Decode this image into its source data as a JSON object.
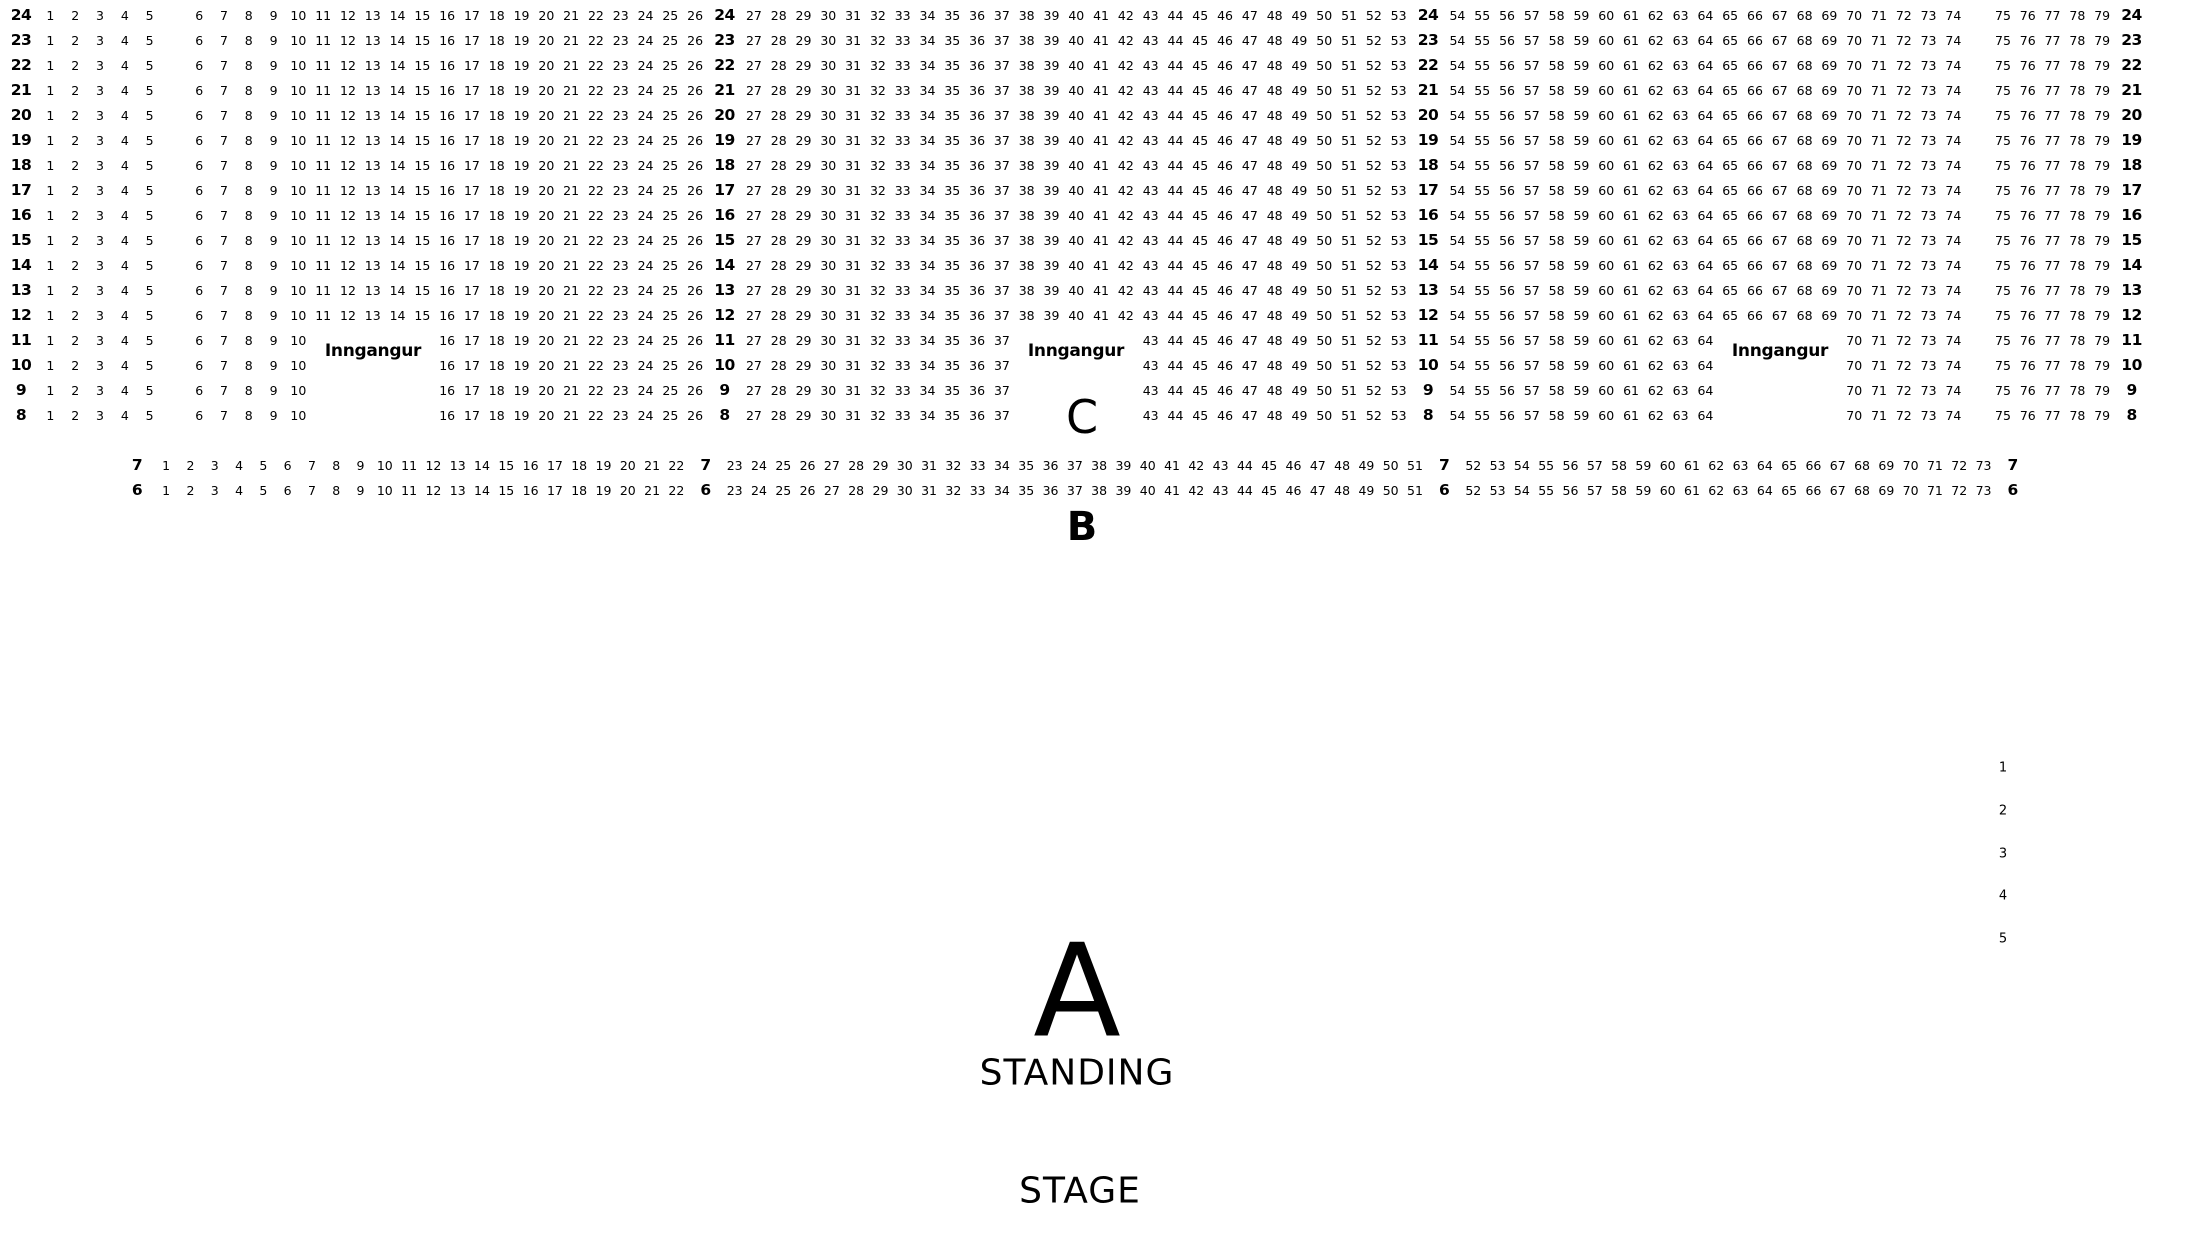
{
  "colors": {
    "background": "#ffffff",
    "text": "#000000"
  },
  "seatmap": {
    "entrance_label": "Inngangur",
    "section_c_label": "C",
    "section_b_label": "B",
    "section_a_label": "A",
    "standing_label": "STANDING",
    "stage_label": "STAGE",
    "side_row_numbers": [
      "1",
      "2",
      "3",
      "4",
      "5"
    ],
    "row_templates": {
      "full": [
        {
          "t": "label"
        },
        {
          "t": "seats",
          "from": 1,
          "to": 5
        },
        {
          "t": "gap",
          "n": 1
        },
        {
          "t": "seats",
          "from": 6,
          "to": 26
        },
        {
          "t": "label"
        },
        {
          "t": "seats",
          "from": 27,
          "to": 53
        },
        {
          "t": "label"
        },
        {
          "t": "seats",
          "from": 54,
          "to": 74
        },
        {
          "t": "gap",
          "n": 1
        },
        {
          "t": "seats",
          "from": 75,
          "to": 79
        },
        {
          "t": "label"
        }
      ],
      "split": [
        {
          "t": "label"
        },
        {
          "t": "seats",
          "from": 1,
          "to": 5
        },
        {
          "t": "gap",
          "n": 1
        },
        {
          "t": "seats",
          "from": 6,
          "to": 10
        },
        {
          "t": "gap",
          "n": 5
        },
        {
          "t": "seats",
          "from": 16,
          "to": 26
        },
        {
          "t": "label"
        },
        {
          "t": "seats",
          "from": 27,
          "to": 37
        },
        {
          "t": "gap",
          "n": 5
        },
        {
          "t": "seats",
          "from": 43,
          "to": 53
        },
        {
          "t": "label"
        },
        {
          "t": "seats",
          "from": 54,
          "to": 64
        },
        {
          "t": "gap",
          "n": 5
        },
        {
          "t": "seats",
          "from": 70,
          "to": 74
        },
        {
          "t": "gap",
          "n": 1
        },
        {
          "t": "seats",
          "from": 75,
          "to": 79
        },
        {
          "t": "label"
        }
      ],
      "floor": [
        {
          "t": "label"
        },
        {
          "t": "seats",
          "from": 1,
          "to": 22
        },
        {
          "t": "label"
        },
        {
          "t": "seats",
          "from": 23,
          "to": 51
        },
        {
          "t": "label"
        },
        {
          "t": "seats",
          "from": 52,
          "to": 73
        },
        {
          "t": "label"
        }
      ]
    },
    "rows": [
      {
        "label": "24",
        "template": "full"
      },
      {
        "label": "23",
        "template": "full"
      },
      {
        "label": "22",
        "template": "full"
      },
      {
        "label": "21",
        "template": "full"
      },
      {
        "label": "20",
        "template": "full"
      },
      {
        "label": "19",
        "template": "full"
      },
      {
        "label": "18",
        "template": "full"
      },
      {
        "label": "17",
        "template": "full"
      },
      {
        "label": "16",
        "template": "full"
      },
      {
        "label": "15",
        "template": "full"
      },
      {
        "label": "14",
        "template": "full"
      },
      {
        "label": "13",
        "template": "full"
      },
      {
        "label": "12",
        "template": "full"
      },
      {
        "label": "11",
        "template": "split"
      },
      {
        "label": "10",
        "template": "split"
      },
      {
        "label": "9",
        "template": "split"
      },
      {
        "label": "8",
        "template": "split"
      },
      {
        "label": "7",
        "template": "floor"
      },
      {
        "label": "6",
        "template": "floor"
      }
    ]
  }
}
